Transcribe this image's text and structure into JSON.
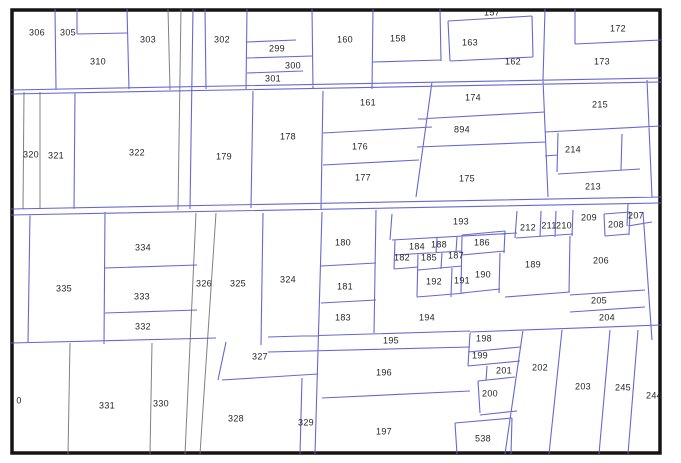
{
  "map": {
    "type": "cadastral-parcel-map",
    "colors": {
      "background": "#ffffff",
      "frame": "#151515",
      "line": "#5a5ace",
      "gray_line": "#6e7278",
      "label": "#26262a"
    },
    "parcels": [
      {
        "id": "306",
        "x": 37,
        "y": 33
      },
      {
        "id": "305",
        "x": 68,
        "y": 33
      },
      {
        "id": "310",
        "x": 98,
        "y": 62
      },
      {
        "id": "303",
        "x": 148,
        "y": 40
      },
      {
        "id": "302",
        "x": 222,
        "y": 40
      },
      {
        "id": "299",
        "x": 277,
        "y": 49
      },
      {
        "id": "300",
        "x": 293,
        "y": 66
      },
      {
        "id": "301",
        "x": 273,
        "y": 79
      },
      {
        "id": "160",
        "x": 345,
        "y": 40
      },
      {
        "id": "158",
        "x": 398,
        "y": 39
      },
      {
        "id": "157",
        "x": 492,
        "y": 13
      },
      {
        "id": "163",
        "x": 470,
        "y": 43
      },
      {
        "id": "162",
        "x": 513,
        "y": 62
      },
      {
        "id": "172",
        "x": 618,
        "y": 29
      },
      {
        "id": "173",
        "x": 602,
        "y": 62
      },
      {
        "id": "174",
        "x": 473,
        "y": 98
      },
      {
        "id": "161",
        "x": 368,
        "y": 103
      },
      {
        "id": "215",
        "x": 600,
        "y": 105
      },
      {
        "id": "894",
        "x": 462,
        "y": 130
      },
      {
        "id": "178",
        "x": 288,
        "y": 137
      },
      {
        "id": "176",
        "x": 360,
        "y": 147
      },
      {
        "id": "214",
        "x": 573,
        "y": 150
      },
      {
        "id": "322",
        "x": 137,
        "y": 153
      },
      {
        "id": "320",
        "x": 31,
        "y": 155
      },
      {
        "id": "321",
        "x": 56,
        "y": 156
      },
      {
        "id": "179",
        "x": 224,
        "y": 157
      },
      {
        "id": "177",
        "x": 363,
        "y": 178
      },
      {
        "id": "175",
        "x": 467,
        "y": 179
      },
      {
        "id": "213",
        "x": 593,
        "y": 187
      },
      {
        "id": "207",
        "x": 636,
        "y": 216
      },
      {
        "id": "209",
        "x": 589,
        "y": 218
      },
      {
        "id": "193",
        "x": 461,
        "y": 222
      },
      {
        "id": "208",
        "x": 616,
        "y": 225
      },
      {
        "id": "211",
        "x": 549,
        "y": 226
      },
      {
        "id": "210",
        "x": 564,
        "y": 226
      },
      {
        "id": "212",
        "x": 528,
        "y": 228
      },
      {
        "id": "186",
        "x": 482,
        "y": 243
      },
      {
        "id": "180",
        "x": 343,
        "y": 243
      },
      {
        "id": "188",
        "x": 439,
        "y": 245
      },
      {
        "id": "184",
        "x": 417,
        "y": 247
      },
      {
        "id": "334",
        "x": 143,
        "y": 248
      },
      {
        "id": "182",
        "x": 402,
        "y": 258
      },
      {
        "id": "185",
        "x": 429,
        "y": 258
      },
      {
        "id": "187",
        "x": 456,
        "y": 256
      },
      {
        "id": "206",
        "x": 601,
        "y": 261
      },
      {
        "id": "189",
        "x": 533,
        "y": 265
      },
      {
        "id": "190",
        "x": 483,
        "y": 275
      },
      {
        "id": "324",
        "x": 288,
        "y": 280
      },
      {
        "id": "191",
        "x": 462,
        "y": 281
      },
      {
        "id": "192",
        "x": 434,
        "y": 282
      },
      {
        "id": "326",
        "x": 204,
        "y": 284
      },
      {
        "id": "325",
        "x": 238,
        "y": 284
      },
      {
        "id": "181",
        "x": 345,
        "y": 287
      },
      {
        "id": "335",
        "x": 64,
        "y": 289
      },
      {
        "id": "333",
        "x": 142,
        "y": 297
      },
      {
        "id": "205",
        "x": 599,
        "y": 301
      },
      {
        "id": "183",
        "x": 343,
        "y": 318
      },
      {
        "id": "194",
        "x": 427,
        "y": 318
      },
      {
        "id": "204",
        "x": 607,
        "y": 318
      },
      {
        "id": "332",
        "x": 143,
        "y": 327
      },
      {
        "id": "198",
        "x": 484,
        "y": 339
      },
      {
        "id": "195",
        "x": 391,
        "y": 341
      },
      {
        "id": "199",
        "x": 480,
        "y": 356
      },
      {
        "id": "327",
        "x": 260,
        "y": 357
      },
      {
        "id": "202",
        "x": 540,
        "y": 368
      },
      {
        "id": "201",
        "x": 504,
        "y": 371
      },
      {
        "id": "196",
        "x": 384,
        "y": 373
      },
      {
        "id": "203",
        "x": 583,
        "y": 387
      },
      {
        "id": "245",
        "x": 623,
        "y": 388
      },
      {
        "id": "200",
        "x": 490,
        "y": 394
      },
      {
        "id": "244",
        "x": 654,
        "y": 396
      },
      {
        "id": "0",
        "x": 19,
        "y": 401
      },
      {
        "id": "330",
        "x": 161,
        "y": 404
      },
      {
        "id": "331",
        "x": 107,
        "y": 406
      },
      {
        "id": "328",
        "x": 236,
        "y": 419
      },
      {
        "id": "329",
        "x": 306,
        "y": 423
      },
      {
        "id": "197",
        "x": 384,
        "y": 432
      },
      {
        "id": "538",
        "x": 483,
        "y": 439
      }
    ]
  }
}
